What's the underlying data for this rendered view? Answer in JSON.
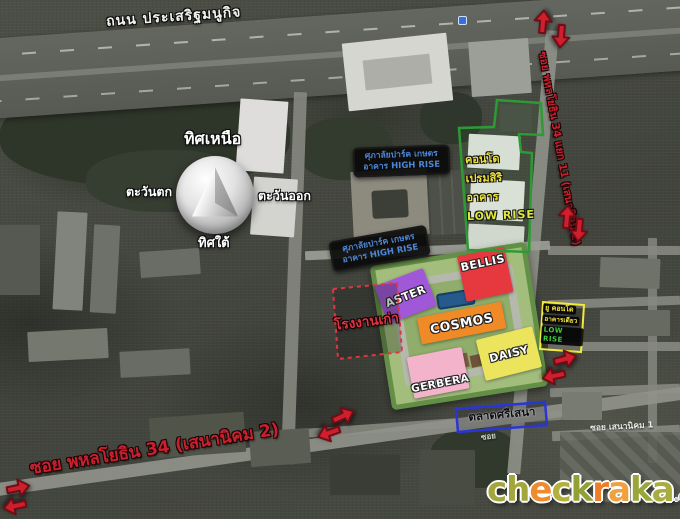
{
  "roads": {
    "top_label": "ถนน ประเสริฐมนูกิจ",
    "right_label": "ซอย พหลโยธิน 34 แยก 11 (เสนานิคม 2)",
    "bottom_label": "ซอย พหลโยธิน 34 (เสนานิคม 2)",
    "minor_label": "ซอย เสนานิคม 1",
    "tiny_label": "ซอย"
  },
  "compass": {
    "north": "ทิศเหนือ",
    "south": "ทิศใต้",
    "east": "ตะวันออก",
    "west": "ตะวันตก"
  },
  "labels": {
    "supalai": {
      "line1": "ศุภาลัยปาร์ค เกษตร",
      "line2": "อาคาร HIGH RISE"
    },
    "premsiri": {
      "line1": "คอนโด",
      "line2": "เปรมสิริ",
      "line3": "อาคาร",
      "line4": "LOW RISE"
    },
    "ucondo": {
      "line1": "ยู คอนโด",
      "line2": "อาคารเดียว",
      "line3": "LOW RISE"
    },
    "old_factory": "โรงงานเก่า",
    "market": "ตลาดศรีเสนา"
  },
  "site": {
    "blocks": [
      {
        "name": "ASTER",
        "color": "#a158d8"
      },
      {
        "name": "BELLIS",
        "color": "#e6383f"
      },
      {
        "name": "COSMOS",
        "color": "#f08a26"
      },
      {
        "name": "GERBERA",
        "color": "#f3b3cb"
      },
      {
        "name": "DAISY",
        "color": "#ece45c"
      }
    ],
    "outline_color": "#648f46"
  },
  "overlays": {
    "premsiri_outline_color": "#2d9b33",
    "factory_outline_color": "#e23540",
    "ucondo_outline_color": "#f2ea3a",
    "market_outline_color": "#2a35d8",
    "arrow_color": "#cf1f2d",
    "highrise_text_color": "#4c86d8",
    "yellow_text_color": "#ece23a"
  },
  "arrows": [
    {
      "x": 530,
      "y": 12,
      "rot": -85
    },
    {
      "x": 548,
      "y": 26,
      "rot": 95
    },
    {
      "x": 554,
      "y": 207,
      "rot": -85
    },
    {
      "x": 566,
      "y": 220,
      "rot": 95
    },
    {
      "x": 552,
      "y": 349,
      "rot": -15
    },
    {
      "x": 541,
      "y": 366,
      "rot": 168
    },
    {
      "x": 330,
      "y": 406,
      "rot": -25
    },
    {
      "x": 316,
      "y": 423,
      "rot": 160
    },
    {
      "x": 5,
      "y": 478,
      "rot": -12
    },
    {
      "x": 2,
      "y": 496,
      "rot": 168
    }
  ],
  "watermark": {
    "letters": [
      {
        "t": "c",
        "c": "#a2a63c"
      },
      {
        "t": "h",
        "c": "#a2a63c"
      },
      {
        "t": "e",
        "c": "#ee8b2e"
      },
      {
        "t": "c",
        "c": "#b4b03e"
      },
      {
        "t": "k",
        "c": "#93a036"
      },
      {
        "t": "r",
        "c": "#ee7d2a"
      },
      {
        "t": "a",
        "c": "#f0a13e"
      },
      {
        "t": "k",
        "c": "#9aa63a"
      },
      {
        "t": "a",
        "c": "#a9ad3e"
      }
    ],
    "suffix": ".com"
  }
}
